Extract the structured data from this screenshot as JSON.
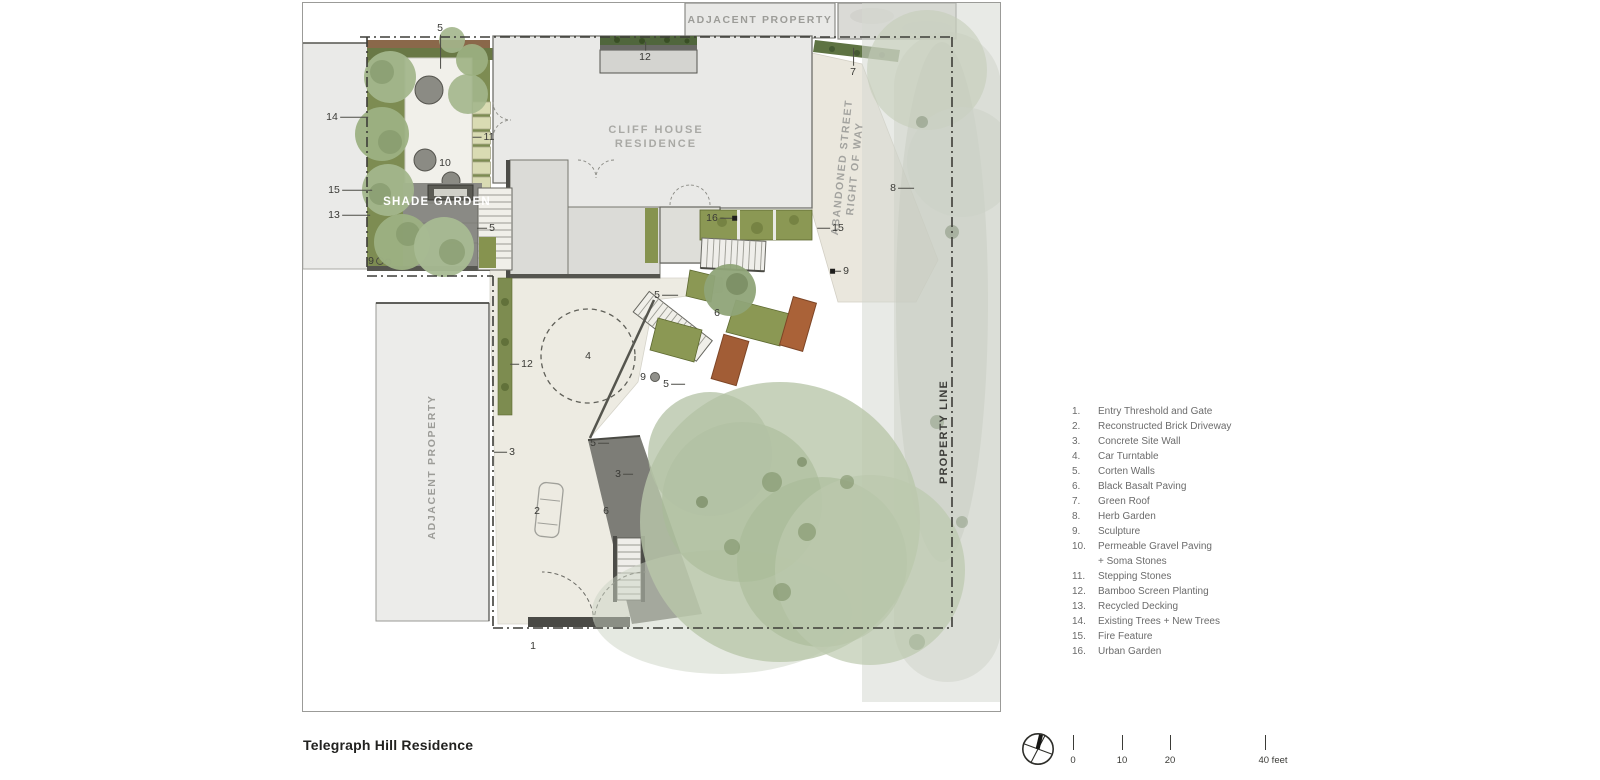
{
  "title_block": {
    "project_title": "Telegraph Hill Residence"
  },
  "plan": {
    "region_labels": {
      "adjacent_property_top": "ADJACENT PROPERTY",
      "adjacent_property_left": "ADJACENT PROPERTY",
      "cliff_house_line1": "CLIFF HOUSE",
      "cliff_house_line2": "RESIDENCE",
      "shade_garden": "SHADE GARDEN",
      "abandoned_street_line1": "ABANDONED STREET",
      "abandoned_street_line2": "RIGHT OF WAY",
      "property_line": "PROPERTY LINE"
    },
    "markers": [
      {
        "n": "5",
        "x": 440,
        "y": 28,
        "dir": "down",
        "len": 34
      },
      {
        "n": "12",
        "x": 645,
        "y": 57,
        "dir": "up",
        "len": 9
      },
      {
        "n": "14",
        "x": 332,
        "y": 117,
        "dir": "right",
        "len": 28
      },
      {
        "n": "11",
        "x": 489,
        "y": 137,
        "dir": "left",
        "len": 9
      },
      {
        "n": "10",
        "x": 445,
        "y": 163
      },
      {
        "n": "15",
        "x": 334,
        "y": 190,
        "dir": "right",
        "len": 30
      },
      {
        "n": "13",
        "x": 334,
        "y": 215,
        "dir": "right",
        "len": 28
      },
      {
        "n": "5",
        "x": 492,
        "y": 228,
        "dir": "left",
        "len": 10
      },
      {
        "n": "9",
        "x": 371,
        "y": 261
      },
      {
        "n": "7",
        "x": 853,
        "y": 72,
        "dir": "up",
        "len": 18
      },
      {
        "n": "8",
        "x": 893,
        "y": 188,
        "dir": "right",
        "len": 16
      },
      {
        "n": "16",
        "x": 712,
        "y": 218,
        "dir": "right",
        "len": 12,
        "end": "square"
      },
      {
        "n": "15",
        "x": 838,
        "y": 228,
        "dir": "left",
        "len": 13
      },
      {
        "n": "9",
        "x": 846,
        "y": 271,
        "dir": "left",
        "len": 6,
        "end": "square"
      },
      {
        "n": "5",
        "x": 657,
        "y": 295,
        "dir": "right",
        "len": 16
      },
      {
        "n": "6",
        "x": 717,
        "y": 313
      },
      {
        "n": "4",
        "x": 588,
        "y": 356
      },
      {
        "n": "12",
        "x": 527,
        "y": 364,
        "dir": "left",
        "len": 9
      },
      {
        "n": "9",
        "x": 643,
        "y": 377
      },
      {
        "n": "5",
        "x": 666,
        "y": 384,
        "dir": "right",
        "len": 14
      },
      {
        "n": "5",
        "x": 593,
        "y": 443,
        "dir": "right",
        "len": 11
      },
      {
        "n": "3",
        "x": 512,
        "y": 452,
        "dir": "left",
        "len": 13
      },
      {
        "n": "3",
        "x": 618,
        "y": 474,
        "dir": "right",
        "len": 10
      },
      {
        "n": "2",
        "x": 537,
        "y": 511
      },
      {
        "n": "6",
        "x": 606,
        "y": 511
      },
      {
        "n": "1",
        "x": 533,
        "y": 646
      }
    ]
  },
  "legend": {
    "items": [
      {
        "num": "1.",
        "label": "Entry Threshold and Gate"
      },
      {
        "num": "2.",
        "label": "Reconstructed Brick Driveway"
      },
      {
        "num": "3.",
        "label": "Concrete Site Wall"
      },
      {
        "num": "4.",
        "label": "Car Turntable"
      },
      {
        "num": "5.",
        "label": "Corten Walls"
      },
      {
        "num": "6.",
        "label": "Black Basalt Paving"
      },
      {
        "num": "7.",
        "label": "Green Roof"
      },
      {
        "num": "8.",
        "label": "Herb Garden"
      },
      {
        "num": "9.",
        "label": "Sculpture"
      },
      {
        "num": "10.",
        "label": "Permeable Gravel Paving",
        "label2": "+ Soma Stones"
      },
      {
        "num": "11.",
        "label": "Stepping Stones"
      },
      {
        "num": "12.",
        "label": "Bamboo Screen Planting"
      },
      {
        "num": "13.",
        "label": "Recycled Decking"
      },
      {
        "num": "14.",
        "label": "Existing Trees +  New Trees"
      },
      {
        "num": "15.",
        "label": "Fire Feature"
      },
      {
        "num": "16.",
        "label": "Urban Garden"
      }
    ]
  },
  "scale_bar": {
    "ticks": [
      {
        "label": "0"
      },
      {
        "label": "10"
      },
      {
        "label": "20"
      },
      {
        "label": "40 feet"
      }
    ]
  }
}
